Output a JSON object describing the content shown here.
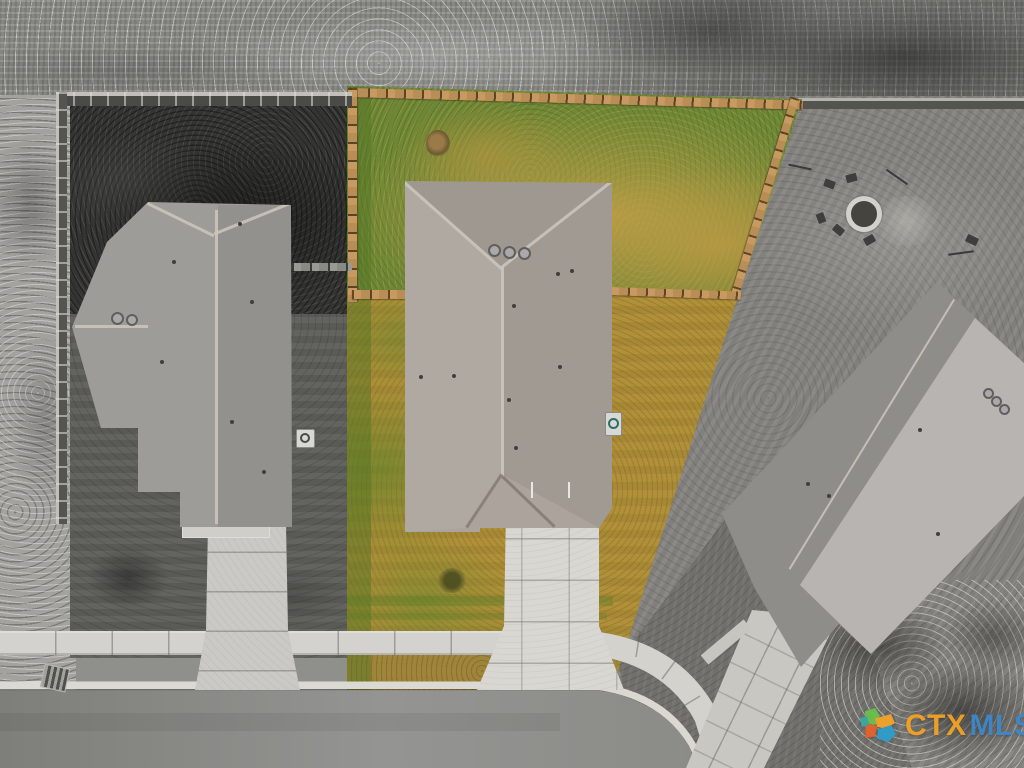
{
  "watermark": {
    "prefix": "CTX",
    "suffix": "MLS",
    "prefix_color": "#F1A227",
    "suffix_color": "#3F86C6",
    "logo_piece_colors": [
      "#6ABF4B",
      "#F2A22B",
      "#2F9CC9",
      "#E2622E",
      "#3AA8A0"
    ]
  },
  "scene": {
    "type": "aerial-drone-real-estate-photo",
    "style": "featured center lot shown in full color; neighboring lots, field and street desaturated to grayscale",
    "palette": {
      "featured_lawn_green": "#6E8734",
      "featured_lawn_amber": "#B09038",
      "wood_fence": "#C89A62",
      "featured_roof": "#ACA49C",
      "left_neighbor_roof": "#9E9C98",
      "right_neighbor_roof": "#8F8D8A",
      "concrete": "#D3D2CE",
      "asphalt": "#8C8C88",
      "grayscale_field": "#90908C"
    },
    "elements": {
      "field": "scrub field behind the back fences",
      "left_house": "grayscale neighbor house with hip roof, driveway and dark fenced backyard",
      "center_house": "featured house with wood-fenced backyard, three roof vents and front driveway",
      "right_house": "grayscale angled neighbor house with fire-pit patio and sloped driveway",
      "street": "residential street curving at lower right with curb, parkway strip and sidewalk"
    }
  }
}
